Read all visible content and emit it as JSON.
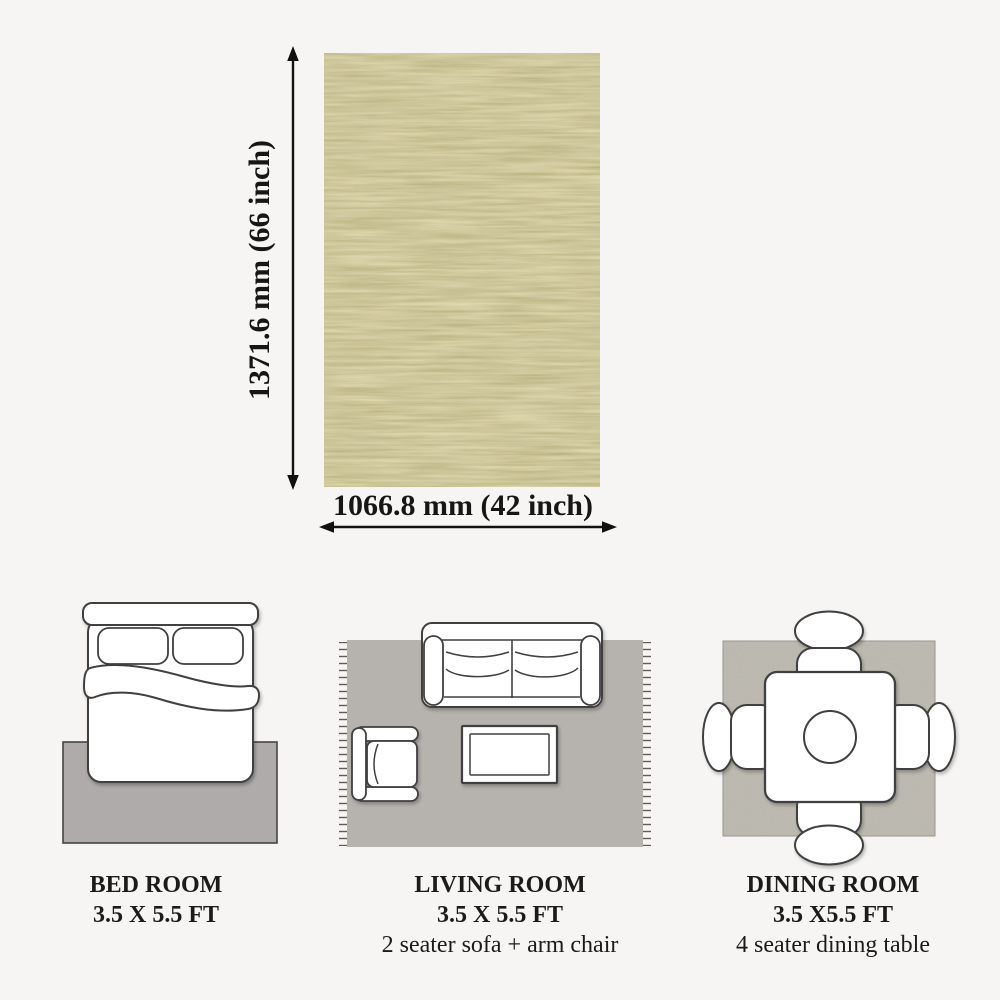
{
  "product": {
    "height_label": "1371.6 mm (66 inch)",
    "width_label": "1066.8 mm (42 inch)"
  },
  "rooms": [
    {
      "name": "BED ROOM",
      "size": "3.5 X 5.5 FT",
      "detail": ""
    },
    {
      "name": "LIVING ROOM",
      "size": "3.5 X 5.5 FT",
      "detail": "2 seater sofa + arm chair"
    },
    {
      "name": "DINING ROOM",
      "size": "3.5 X5.5 FT",
      "detail": "4 seater dining table"
    }
  ],
  "icons": {
    "vertical_dimension_arrow": "double-headed up-down arrow",
    "horizontal_dimension_arrow": "double-headed left-right arrow",
    "bed_topview": "double bed seen from above on rug",
    "sofa_topview": "2 seater sofa, arm chair and coffee table on rug",
    "dining_topview": "square table with 4 chairs on rug"
  },
  "colors": {
    "page_background": "#f6f5f3",
    "rug_khaki_mid": "#a89f68",
    "room_rug_gray": "#b3afab",
    "outline": "#3f3f3f",
    "arrow": "#111111",
    "text": "#1b1b1b"
  }
}
